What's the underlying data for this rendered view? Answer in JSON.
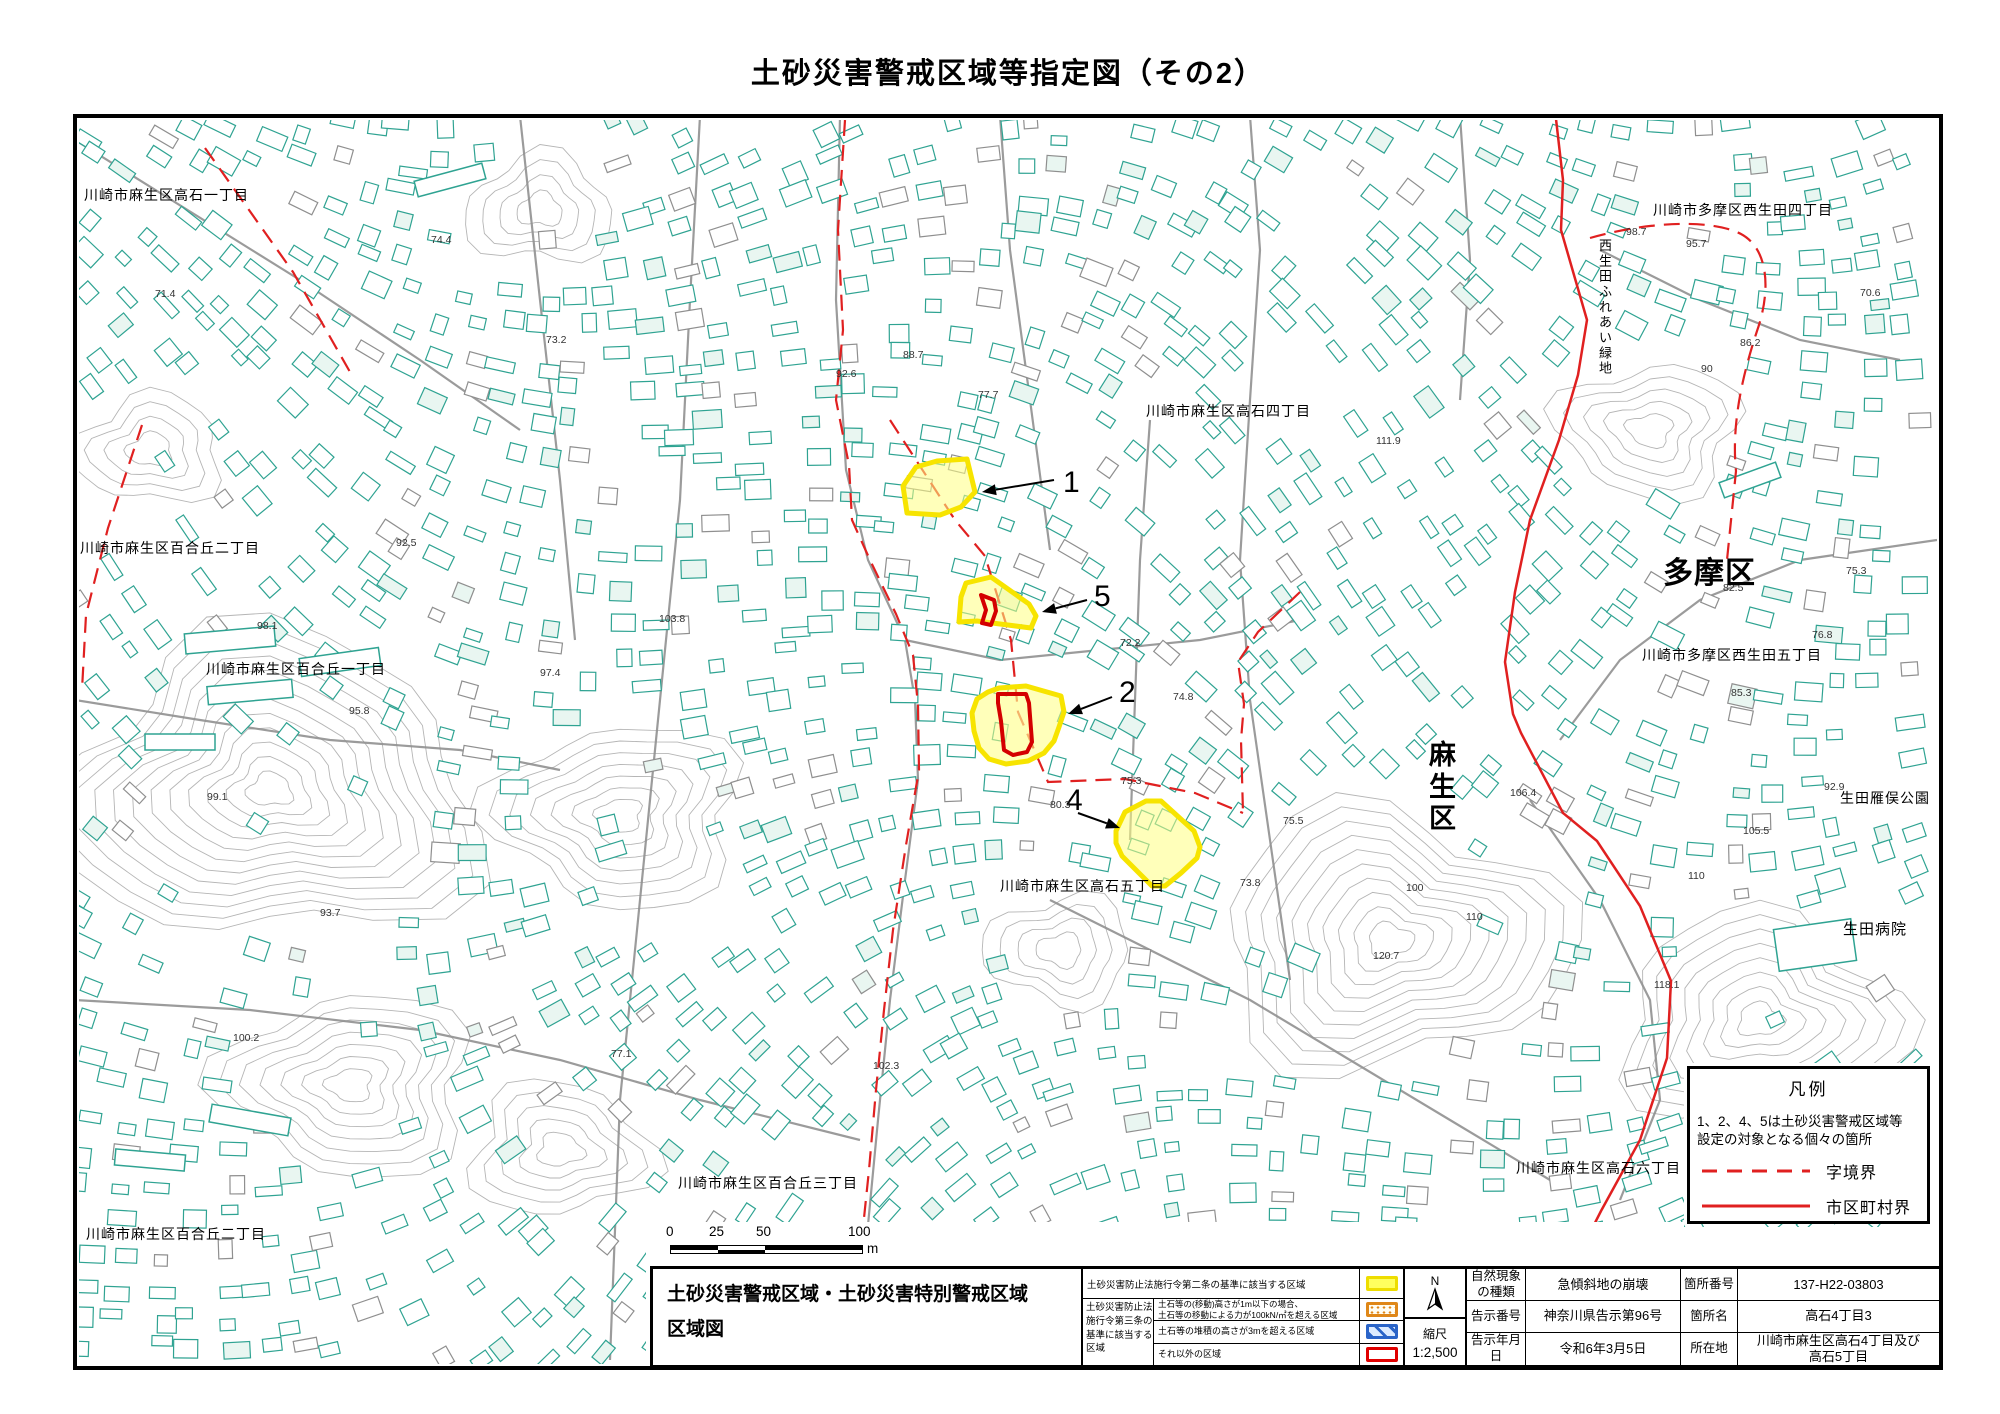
{
  "page_title": "土砂災害警戒区域等指定図（その2）",
  "colors": {
    "zone_border": "#f7e400",
    "zone_fill": "rgba(255,255,130,0.55)",
    "zone_inner_border": "#d40000",
    "boundary_red": "#e02020",
    "building_teal": "#2fa392",
    "building_gray": "#8f8f8f",
    "contour_gray": "#b5b5b5",
    "road_gray": "#909090"
  },
  "map": {
    "area_labels": [
      {
        "text": "川崎市麻生区高石一丁目",
        "x": 84,
        "y": 200,
        "size": 14
      },
      {
        "text": "川崎市多摩区西生田四丁目",
        "x": 1653,
        "y": 215,
        "size": 14
      },
      {
        "text": "西生田ふれあい緑地",
        "x": 1599,
        "y": 250,
        "size": 13,
        "vertical": true
      },
      {
        "text": "川崎市麻生区高石四丁目",
        "x": 1146,
        "y": 416,
        "size": 14
      },
      {
        "text": "川崎市麻生区百合丘二丁目",
        "x": 80,
        "y": 553,
        "size": 14
      },
      {
        "text": "多摩区",
        "x": 1663,
        "y": 583,
        "size": 30,
        "bold": true
      },
      {
        "text": "川崎市多摩区西生田五丁目",
        "x": 1642,
        "y": 660,
        "size": 14
      },
      {
        "text": "川崎市麻生区百合丘一丁目",
        "x": 206,
        "y": 674,
        "size": 14
      },
      {
        "text": "麻生区",
        "x": 1429,
        "y": 764,
        "size": 27,
        "bold": true,
        "vertical": true
      },
      {
        "text": "生田雁俣公園",
        "x": 1840,
        "y": 803,
        "size": 14
      },
      {
        "text": "川崎市麻生区高石五丁目",
        "x": 1000,
        "y": 891,
        "size": 14
      },
      {
        "text": "生田病院",
        "x": 1843,
        "y": 934,
        "size": 15
      },
      {
        "text": "川崎市麻生区高石六丁目",
        "x": 1516,
        "y": 1173,
        "size": 14
      },
      {
        "text": "川崎市麻生区百合丘三丁目",
        "x": 678,
        "y": 1188,
        "size": 14
      },
      {
        "text": "川崎市麻生区百合丘二丁目",
        "x": 86,
        "y": 1239,
        "size": 14
      }
    ],
    "zones": [
      {
        "label": "1",
        "points": "903,486 916,467 937,461 967,459 975,492 961,507 940,515 907,513",
        "label_x": 1063,
        "label_y": 492,
        "arrow": [
          1054,
          480,
          982,
          492
        ]
      },
      {
        "label": "5",
        "points": "966,583 991,577 1029,604 1036,616 1031,628 1000,624 977,621 959,622 961,597",
        "inner_points": "981,595 994,600 996,611 991,625 982,623 986,610",
        "label_x": 1094,
        "label_y": 606,
        "arrow": [
          1087,
          600,
          1042,
          612
        ]
      },
      {
        "label": "2",
        "points": "999,688 1026,686 1061,696 1064,712 1059,727 1054,741 1044,753 1028,761 1006,764 989,759 979,748 974,731 972,713 977,699 988,692",
        "inner_points": "998,694 1026,694 1029,703 1032,742 1027,752 1013,755 1004,750 1001,721 998,703",
        "label_x": 1119,
        "label_y": 702,
        "arrow": [
          1112,
          697,
          1068,
          714
        ]
      },
      {
        "label": "4",
        "points": "1116,831 1125,812 1146,801 1161,801 1194,831 1200,847 1197,858 1181,873 1165,886 1152,886 1122,856 1116,843",
        "label_x": 1066,
        "label_y": 810,
        "arrow": [
          1078,
          813,
          1120,
          828
        ]
      }
    ],
    "spot_elevations": [
      {
        "v": "71.4",
        "x": 155,
        "y": 297
      },
      {
        "v": "74.4",
        "x": 431,
        "y": 243
      },
      {
        "v": "73.2",
        "x": 546,
        "y": 343
      },
      {
        "v": "88.7",
        "x": 903,
        "y": 358
      },
      {
        "v": "92.6",
        "x": 836,
        "y": 377
      },
      {
        "v": "77.7",
        "x": 978,
        "y": 398
      },
      {
        "v": "111.9",
        "x": 1376,
        "y": 444
      },
      {
        "v": "92.5",
        "x": 396,
        "y": 546
      },
      {
        "v": "98.1",
        "x": 257,
        "y": 629
      },
      {
        "v": "98.7",
        "x": 1626,
        "y": 235
      },
      {
        "v": "95.7",
        "x": 1686,
        "y": 247
      },
      {
        "v": "70.6",
        "x": 1860,
        "y": 296
      },
      {
        "v": "86.2",
        "x": 1740,
        "y": 346
      },
      {
        "v": "90",
        "x": 1701,
        "y": 372
      },
      {
        "v": "82.5",
        "x": 1723,
        "y": 591
      },
      {
        "v": "75.3",
        "x": 1846,
        "y": 574
      },
      {
        "v": "76.8",
        "x": 1812,
        "y": 638
      },
      {
        "v": "85.3",
        "x": 1731,
        "y": 696
      },
      {
        "v": "92.9",
        "x": 1824,
        "y": 790
      },
      {
        "v": "72.2",
        "x": 1120,
        "y": 646
      },
      {
        "v": "74.8",
        "x": 1173,
        "y": 700
      },
      {
        "v": "75.3",
        "x": 1121,
        "y": 784
      },
      {
        "v": "80.3",
        "x": 1050,
        "y": 808
      },
      {
        "v": "75.5",
        "x": 1283,
        "y": 824
      },
      {
        "v": "73.8",
        "x": 1240,
        "y": 886
      },
      {
        "v": "77.1",
        "x": 611,
        "y": 1057
      },
      {
        "v": "102.3",
        "x": 873,
        "y": 1069
      },
      {
        "v": "106.4",
        "x": 1510,
        "y": 796
      },
      {
        "v": "100",
        "x": 1406,
        "y": 891
      },
      {
        "v": "110",
        "x": 1466,
        "y": 920
      },
      {
        "v": "120.7",
        "x": 1373,
        "y": 959
      },
      {
        "v": "105.5",
        "x": 1743,
        "y": 834
      },
      {
        "v": "110",
        "x": 1688,
        "y": 879
      },
      {
        "v": "103.8",
        "x": 659,
        "y": 622
      },
      {
        "v": "97.4",
        "x": 540,
        "y": 676
      },
      {
        "v": "95.8",
        "x": 349,
        "y": 714
      },
      {
        "v": "99.1",
        "x": 207,
        "y": 800
      },
      {
        "v": "93.7",
        "x": 320,
        "y": 916
      },
      {
        "v": "100.2",
        "x": 233,
        "y": 1041
      },
      {
        "v": "118.1",
        "x": 1654,
        "y": 988
      }
    ]
  },
  "legend_box": {
    "title": "凡例",
    "note": "1、2、4、5は土砂災害警戒区域等\n設定の対象となる個々の箇所",
    "items": [
      {
        "style": "dashed",
        "label": "字境界"
      },
      {
        "style": "solid",
        "label": "市区町村界"
      }
    ]
  },
  "scale_bar": {
    "labels": [
      "0",
      "25",
      "50",
      "100"
    ],
    "unit": "m"
  },
  "sheet_table": {
    "map_title": "土砂災害警戒区域・土砂災害特別警戒区域\n区域図",
    "law": {
      "row1_label": "土砂災害防止法施行令第二条の基準に該当する区域",
      "group_label": "土砂災害防止法\n施行令第三条の\n基準に該当する\n区域",
      "row2_label": "土石等の(移動)高さが1m以下の場合、\n土石等の移動による力が100kN/㎡を超える区域",
      "row3_label": "土石等の堆積の高さが3mを超える区域",
      "row4_label": "それ以外の区域"
    },
    "compass_label": "N",
    "scale_label": "縮尺",
    "scale_value": "1:2,500",
    "info": [
      {
        "label": "自然現象\nの種類",
        "value": "急傾斜地の崩壊",
        "label2": "箇所番号",
        "value2": "137-H22-03803"
      },
      {
        "label": "告示番号",
        "value": "神奈川県告示第96号",
        "label2": "箇所名",
        "value2": "高石4丁目3"
      },
      {
        "label": "告示年月日",
        "value": "令和6年3月5日",
        "label2": "所在地",
        "value2": "川崎市麻生区高石4丁目及び\n高石5丁目"
      }
    ]
  }
}
